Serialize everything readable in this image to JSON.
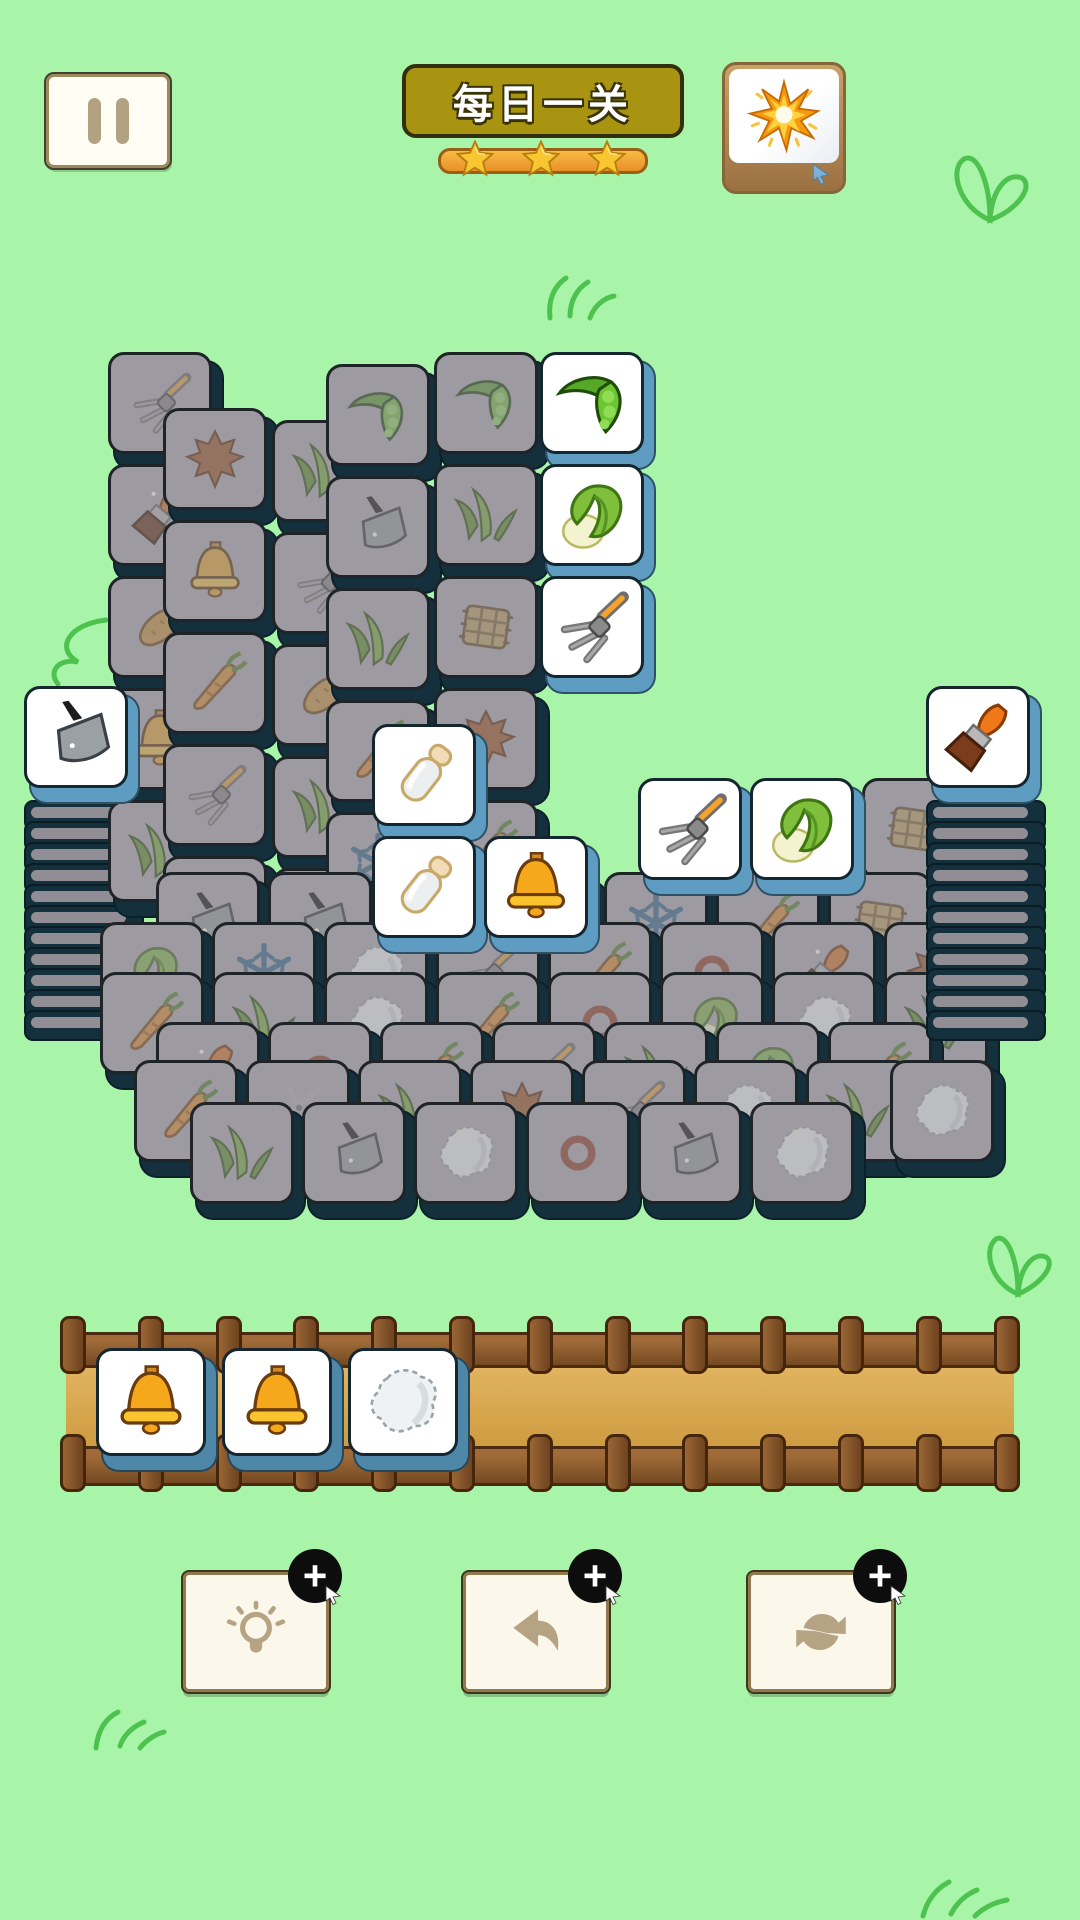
{
  "header": {
    "title": "每日一关",
    "stars_count": 3,
    "pause_icon": "pause",
    "booster_icon": "starburst"
  },
  "colors": {
    "background": "#a8f4a8",
    "doodle_green": "#4ec24e",
    "tile_down_face": "#9d9aa1",
    "tile_edge_dark": "#14303c",
    "tile_up_face": "#ffffff",
    "tile_up_edge": "#5f9cc2",
    "tray_tile_edge": "#4f87a8",
    "title_plate": "#a89410",
    "star_gold": "#f7c631",
    "star_bar_orange": "#f2a33c",
    "wood_brown": "#8a5a30",
    "tray_floor": "#d9a74e",
    "button_icon_tan": "#b5a384",
    "badge_black": "#0d0d0d"
  },
  "board": {
    "tile_size": 112,
    "left_pile": {
      "x": 24,
      "edge_y": 800,
      "edge_step": 21,
      "edge_count": 11,
      "top": {
        "x": 24,
        "y": 686,
        "kind": "up",
        "icon": "cleaver"
      }
    },
    "right_pile": {
      "x": 926,
      "edge_y": 800,
      "edge_step": 21,
      "edge_count": 11,
      "top": {
        "x": 926,
        "y": 686,
        "kind": "up",
        "icon": "brush"
      }
    },
    "down_tiles": [
      {
        "x": 108,
        "y": 352,
        "icon": "fork"
      },
      {
        "x": 108,
        "y": 464,
        "icon": "brush"
      },
      {
        "x": 108,
        "y": 576,
        "icon": "potato"
      },
      {
        "x": 108,
        "y": 688,
        "icon": "bell"
      },
      {
        "x": 108,
        "y": 800,
        "icon": "grass"
      },
      {
        "x": 163,
        "y": 408,
        "icon": "leaf"
      },
      {
        "x": 163,
        "y": 520,
        "icon": "bell"
      },
      {
        "x": 163,
        "y": 632,
        "icon": "carrot"
      },
      {
        "x": 163,
        "y": 744,
        "icon": "fork"
      },
      {
        "x": 163,
        "y": 856,
        "icon": "grass"
      },
      {
        "x": 272,
        "y": 420,
        "icon": "grass"
      },
      {
        "x": 272,
        "y": 532,
        "icon": "fork"
      },
      {
        "x": 272,
        "y": 644,
        "icon": "potato"
      },
      {
        "x": 272,
        "y": 756,
        "icon": "grass"
      },
      {
        "x": 272,
        "y": 868,
        "icon": "scissors"
      },
      {
        "x": 326,
        "y": 364,
        "icon": "pea"
      },
      {
        "x": 326,
        "y": 476,
        "icon": "cleaver"
      },
      {
        "x": 326,
        "y": 588,
        "icon": "grass"
      },
      {
        "x": 326,
        "y": 700,
        "icon": "carrot"
      },
      {
        "x": 326,
        "y": 812,
        "icon": "snow"
      },
      {
        "x": 434,
        "y": 352,
        "icon": "pea"
      },
      {
        "x": 434,
        "y": 464,
        "icon": "grass"
      },
      {
        "x": 434,
        "y": 576,
        "icon": "hay"
      },
      {
        "x": 434,
        "y": 688,
        "icon": "leaf"
      },
      {
        "x": 434,
        "y": 800,
        "icon": "carrot"
      },
      {
        "x": 862,
        "y": 778,
        "icon": "hay"
      },
      {
        "x": 156,
        "y": 872,
        "icon": "cleaver"
      },
      {
        "x": 268,
        "y": 872,
        "icon": "cleaver"
      },
      {
        "x": 380,
        "y": 872,
        "icon": "bottle"
      },
      {
        "x": 492,
        "y": 872,
        "icon": "cleaver"
      },
      {
        "x": 604,
        "y": 872,
        "icon": "snow"
      },
      {
        "x": 716,
        "y": 872,
        "icon": "carrot"
      },
      {
        "x": 828,
        "y": 872,
        "icon": "hay"
      },
      {
        "x": 100,
        "y": 922,
        "icon": "cabbage"
      },
      {
        "x": 212,
        "y": 922,
        "icon": "snow"
      },
      {
        "x": 324,
        "y": 922,
        "icon": "cotton"
      },
      {
        "x": 436,
        "y": 922,
        "icon": "fork"
      },
      {
        "x": 548,
        "y": 922,
        "icon": "carrot"
      },
      {
        "x": 660,
        "y": 922,
        "icon": "ring"
      },
      {
        "x": 772,
        "y": 922,
        "icon": "brush"
      },
      {
        "x": 884,
        "y": 922,
        "icon": "leaf"
      },
      {
        "x": 100,
        "y": 972,
        "icon": "carrot"
      },
      {
        "x": 212,
        "y": 972,
        "icon": "grass"
      },
      {
        "x": 324,
        "y": 972,
        "icon": "cotton"
      },
      {
        "x": 436,
        "y": 972,
        "icon": "carrot"
      },
      {
        "x": 548,
        "y": 972,
        "icon": "ring"
      },
      {
        "x": 660,
        "y": 972,
        "icon": "cabbage"
      },
      {
        "x": 772,
        "y": 972,
        "icon": "cotton"
      },
      {
        "x": 884,
        "y": 972,
        "icon": "grass"
      },
      {
        "x": 156,
        "y": 1022,
        "icon": "brush"
      },
      {
        "x": 268,
        "y": 1022,
        "icon": "ring"
      },
      {
        "x": 380,
        "y": 1022,
        "icon": "carrot"
      },
      {
        "x": 492,
        "y": 1022,
        "icon": "fork"
      },
      {
        "x": 604,
        "y": 1022,
        "icon": "grass"
      },
      {
        "x": 716,
        "y": 1022,
        "icon": "cabbage"
      },
      {
        "x": 828,
        "y": 1022,
        "icon": "carrot"
      },
      {
        "x": 134,
        "y": 1060,
        "icon": "carrot"
      },
      {
        "x": 246,
        "y": 1060,
        "icon": "scissors"
      },
      {
        "x": 358,
        "y": 1060,
        "icon": "grass"
      },
      {
        "x": 470,
        "y": 1060,
        "icon": "leaf"
      },
      {
        "x": 582,
        "y": 1060,
        "icon": "fork"
      },
      {
        "x": 694,
        "y": 1060,
        "icon": "cotton"
      },
      {
        "x": 806,
        "y": 1060,
        "icon": "grass"
      },
      {
        "x": 890,
        "y": 1060,
        "icon": "cotton"
      },
      {
        "x": 190,
        "y": 1102,
        "icon": "grass"
      },
      {
        "x": 302,
        "y": 1102,
        "icon": "cleaver"
      },
      {
        "x": 414,
        "y": 1102,
        "icon": "cotton"
      },
      {
        "x": 526,
        "y": 1102,
        "icon": "ring"
      },
      {
        "x": 638,
        "y": 1102,
        "icon": "cleaver"
      },
      {
        "x": 750,
        "y": 1102,
        "icon": "cotton"
      }
    ],
    "up_tiles": [
      {
        "x": 540,
        "y": 352,
        "icon": "pea"
      },
      {
        "x": 540,
        "y": 464,
        "icon": "cabbage"
      },
      {
        "x": 540,
        "y": 576,
        "icon": "fork"
      },
      {
        "x": 638,
        "y": 778,
        "icon": "fork"
      },
      {
        "x": 750,
        "y": 778,
        "icon": "cabbage"
      },
      {
        "x": 372,
        "y": 724,
        "icon": "bottle"
      },
      {
        "x": 372,
        "y": 836,
        "icon": "bottle"
      },
      {
        "x": 484,
        "y": 836,
        "icon": "bell"
      }
    ]
  },
  "tray": {
    "post_count": 13,
    "tile_start_x": 36,
    "tile_gap": 126,
    "tile_y": 32,
    "tiles": [
      {
        "icon": "bell"
      },
      {
        "icon": "bell"
      },
      {
        "icon": "cotton"
      }
    ]
  },
  "toolbar": {
    "badge_label": "+",
    "buttons": [
      {
        "id": "hint",
        "icon": "bulb",
        "x": 183
      },
      {
        "id": "undo",
        "icon": "undo",
        "x": 463
      },
      {
        "id": "shuffle",
        "icon": "refresh",
        "x": 748
      }
    ]
  }
}
